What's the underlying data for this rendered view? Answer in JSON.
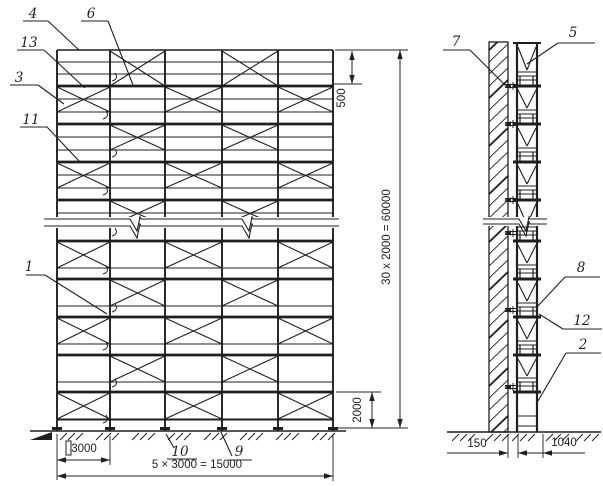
{
  "canvas": {
    "width": 603,
    "height": 486,
    "paper": "#ffffff",
    "ink": "#1f1f1f"
  },
  "front_view": {
    "posts_x": [
      57,
      110,
      165,
      222,
      278,
      333
    ],
    "top_y": 50,
    "ground_y": 431,
    "guard_rails_y": [
      62,
      74
    ],
    "deck_ys": [
      86,
      124,
      162,
      200,
      241,
      279,
      317,
      355,
      392
    ],
    "upper_decks": [
      86,
      124,
      162,
      200
    ],
    "rail_offsets_upper": [
      13,
      26
    ],
    "rail_offset_lower": 27,
    "bottom_rail_y": 420,
    "modules": [
      {
        "y0": 50,
        "y1": 86,
        "bays": [
          1,
          3
        ]
      },
      {
        "y0": 86,
        "y1": 112,
        "bays": [
          0,
          2,
          4
        ]
      },
      {
        "y0": 124,
        "y1": 150,
        "bays": [
          1,
          3
        ]
      },
      {
        "y0": 162,
        "y1": 188,
        "bays": [
          0,
          2,
          4
        ]
      },
      {
        "y0": 200,
        "y1": 226,
        "bays": [
          1,
          3
        ]
      },
      {
        "y0": 241,
        "y1": 268,
        "bays": [
          0,
          2,
          4
        ]
      },
      {
        "y0": 279,
        "y1": 306,
        "bays": [
          1,
          3
        ]
      },
      {
        "y0": 317,
        "y1": 344,
        "bays": [
          0,
          2,
          4
        ]
      },
      {
        "y0": 355,
        "y1": 382,
        "bays": [
          1,
          3
        ]
      },
      {
        "y0": 392,
        "y1": 419,
        "bays": [
          0,
          2,
          4
        ]
      }
    ],
    "clamp_ys": [
      81,
      119,
      157,
      195,
      236,
      274,
      312,
      350,
      387,
      423
    ],
    "break_line": {
      "x0": 44,
      "x1": 339,
      "top_y": 219,
      "bot_y": 226,
      "spikes": [
        137,
        249
      ],
      "depth": 12
    },
    "ground": {
      "y": 431,
      "x0": 30,
      "x1": 346,
      "tick_clusters": [
        60,
        96,
        132,
        168,
        204,
        240,
        276,
        312
      ],
      "wedge": [
        30,
        52
      ]
    },
    "jack_rect": {
      "x": 66,
      "y": 441,
      "w": 5,
      "h": 14
    }
  },
  "side_view": {
    "wall": {
      "x0": 489,
      "x1": 508,
      "top_y": 42,
      "hatch_step": 12
    },
    "posts_x": [
      517,
      537
    ],
    "frame_top_y": 43,
    "ground_y": 432,
    "deck_ys": [
      86,
      124,
      162,
      200,
      241,
      279,
      317,
      355,
      392
    ],
    "tie_ys": [
      86,
      124,
      200,
      233,
      310,
      387
    ],
    "last_rungs": [
      416,
      426
    ],
    "break_line": {
      "x0": 483,
      "x1": 547,
      "top_y": 219,
      "bot_y": 224,
      "spikes": [
        526
      ],
      "depth": 12
    },
    "ground": {
      "y": 432,
      "x0": 447,
      "x1": 601,
      "tick_clusters": [
        452,
        486,
        512,
        546,
        576
      ]
    }
  },
  "dimensions": [
    {
      "id": "dim-500",
      "label": "500",
      "orient": "v",
      "line_x": 352,
      "y0": 51,
      "y1": 84,
      "text_x": 345,
      "text_y": 98,
      "ext": [
        [
          333,
          84,
          362,
          84
        ]
      ]
    },
    {
      "id": "dim-60000",
      "label": "30 x 2000 = 60000",
      "orient": "v",
      "line_x": 400,
      "y0": 50,
      "y1": 428,
      "text_x": 390,
      "text_y": 237,
      "ext": [
        [
          335,
          50,
          408,
          50
        ],
        [
          336,
          428,
          408,
          428
        ]
      ]
    },
    {
      "id": "dim-2000",
      "label": "2000",
      "orient": "v",
      "line_x": 372,
      "y0": 392,
      "y1": 428,
      "text_x": 361,
      "text_y": 410,
      "ext": [
        [
          336,
          392,
          381,
          392
        ]
      ]
    },
    {
      "id": "dim-3000",
      "label": "3000",
      "orient": "h",
      "line_y": 460,
      "x0": 57,
      "x1": 110,
      "text_x": 84,
      "text_y": 452,
      "ext": [
        [
          57,
          434,
          57,
          480
        ],
        [
          110,
          436,
          110,
          465
        ]
      ]
    },
    {
      "id": "dim-15000",
      "label": "5 × 3000 = 15000",
      "orient": "h",
      "line_y": 476,
      "x0": 57,
      "x1": 333,
      "text_x": 197,
      "text_y": 468,
      "ext": [
        [
          333,
          434,
          333,
          481
        ]
      ]
    },
    {
      "id": "dim-150",
      "label": "150",
      "orient": "h-out",
      "line_y": 453,
      "x0": 508,
      "x1": 518,
      "tail0": 447,
      "tail1": 532,
      "text_x": 477,
      "text_y": 447,
      "ext": [
        [
          508,
          434,
          508,
          458
        ],
        [
          518,
          434,
          518,
          458
        ]
      ]
    },
    {
      "id": "dim-1040",
      "label": "1040",
      "orient": "h-out2",
      "line_y": 453,
      "x0": 518,
      "x1": 543,
      "tail1": 585,
      "text_x": 564,
      "text_y": 446,
      "ext": [
        [
          543,
          434,
          543,
          458
        ]
      ]
    }
  ],
  "callouts": [
    {
      "id": "4",
      "x": 33,
      "y": 18,
      "ul": [
        23,
        21,
        48,
        21
      ],
      "leader": [
        48,
        21,
        79,
        50
      ]
    },
    {
      "id": "6",
      "x": 91,
      "y": 18,
      "ul": [
        81,
        21,
        108,
        21
      ],
      "leader": [
        108,
        21,
        133,
        85
      ]
    },
    {
      "id": "13",
      "x": 29,
      "y": 47,
      "ul": [
        17,
        50,
        44,
        50
      ],
      "leader": [
        44,
        50,
        85,
        88
      ]
    },
    {
      "id": "3",
      "x": 19,
      "y": 82,
      "ul": [
        10,
        85,
        38,
        85
      ],
      "leader": [
        38,
        85,
        64,
        104
      ]
    },
    {
      "id": "11",
      "x": 31,
      "y": 124,
      "ul": [
        20,
        127,
        47,
        127
      ],
      "leader": [
        47,
        127,
        80,
        162
      ]
    },
    {
      "id": "1",
      "x": 29,
      "y": 271,
      "ul": [
        26,
        275,
        45,
        275
      ],
      "leader": [
        45,
        275,
        107,
        314
      ]
    },
    {
      "id": "10",
      "x": 180,
      "y": 456,
      "ul": [
        167,
        459,
        197,
        459
      ],
      "leader": [
        174,
        448,
        166,
        434
      ]
    },
    {
      "id": "9",
      "x": 239,
      "y": 456,
      "ul": [
        228,
        460,
        252,
        460
      ],
      "leader": [
        232,
        456,
        221,
        432
      ]
    },
    {
      "id": "7",
      "x": 456,
      "y": 46,
      "ul": [
        443,
        50,
        470,
        50
      ],
      "leader": [
        470,
        50,
        505,
        85
      ]
    },
    {
      "id": "5",
      "x": 573,
      "y": 37,
      "ul": [
        558,
        43,
        595,
        43
      ],
      "leader": [
        558,
        43,
        527,
        64
      ]
    },
    {
      "id": "8",
      "x": 581,
      "y": 272,
      "ul": [
        565,
        277,
        600,
        277
      ],
      "leader": [
        565,
        277,
        536,
        308
      ]
    },
    {
      "id": "12",
      "x": 582,
      "y": 325,
      "ul": [
        563,
        329,
        602,
        329
      ],
      "leader": [
        563,
        329,
        539,
        314
      ]
    },
    {
      "id": "2",
      "x": 583,
      "y": 349,
      "ul": [
        566,
        353,
        601,
        353
      ],
      "leader": [
        566,
        353,
        538,
        401
      ]
    }
  ]
}
